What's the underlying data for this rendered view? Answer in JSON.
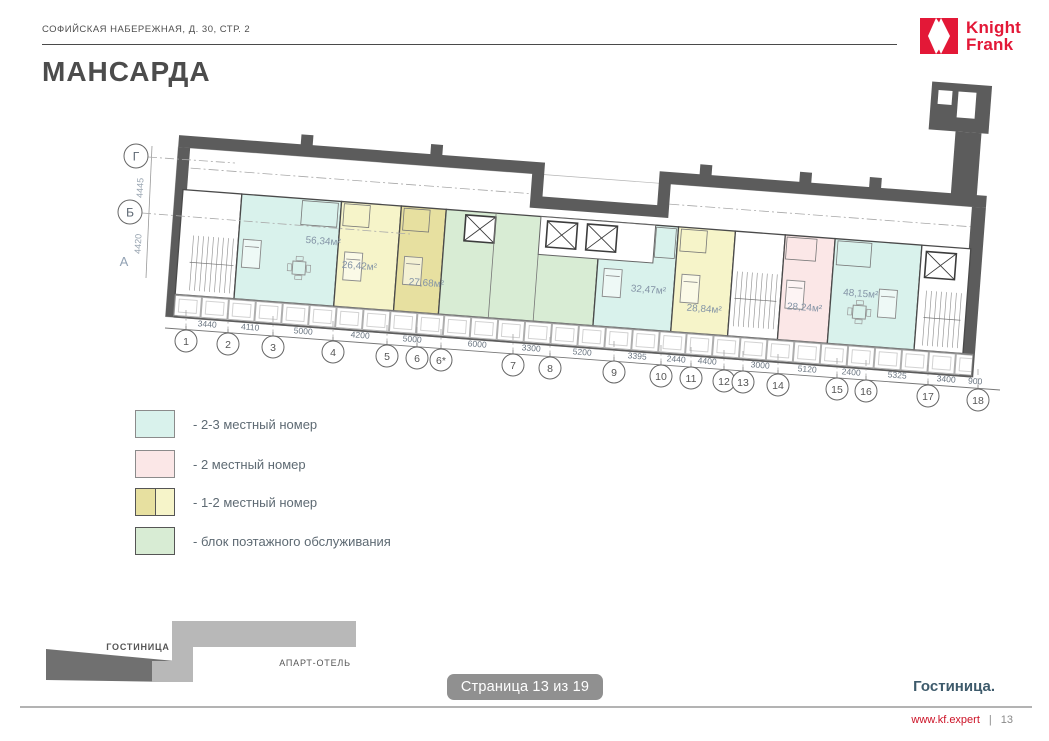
{
  "header": {
    "address": "СОФИЙСКАЯ НАБЕРЕЖНАЯ, Д. 30, СТР. 2",
    "logo_line1": "Knight",
    "logo_line2": "Frank"
  },
  "title": "МАНСАРДА",
  "palette": {
    "brand_red": "#e31837",
    "room_cyan": "#d9f2ec",
    "room_pink": "#fbe7e7",
    "room_yellow_dark": "#e7e0a0",
    "room_yellow_light": "#f6f4c9",
    "room_green": "#d8ecd4",
    "wall_dark": "#5c5c5c",
    "footer_section_color": "#3d5a6b"
  },
  "plan": {
    "axes": [
      {
        "label": "Г",
        "dim": "4445"
      },
      {
        "label": "Б",
        "dim": "4420"
      },
      {
        "label": "А"
      }
    ],
    "columns": [
      "1",
      "2",
      "3",
      "4",
      "5",
      "6",
      "6*",
      "7",
      "8",
      "9",
      "10",
      "11",
      "12",
      "13",
      "14",
      "15",
      "16",
      "17",
      "18"
    ],
    "dims": [
      "3440",
      "4110",
      "5000",
      "4200",
      "5000",
      "6000",
      "3300",
      "5200",
      "3395",
      "2440",
      "4400",
      "3000",
      "5120",
      "2400",
      "5325",
      "3400",
      "900"
    ],
    "rooms": [
      {
        "area": "56,34м²",
        "fill": "#d9f2ec"
      },
      {
        "area": "26,42м²",
        "fill": "#f6f4c9"
      },
      {
        "area": "27,68м²",
        "fill": "#e7e0a0"
      },
      {
        "area": "32,47м²",
        "fill": "#d9f2ec"
      },
      {
        "area": "28,84м²",
        "fill": "#f6f4c9"
      },
      {
        "area": "28,24м²",
        "fill": "#fbe7e7"
      },
      {
        "area": "48,15м²",
        "fill": "#d9f2ec"
      }
    ]
  },
  "legend": {
    "items": [
      {
        "label": "- 2-3 местный номер",
        "color": "#d9f2ec"
      },
      {
        "label": "- 2 местный номер",
        "color": "#fbe7e7"
      },
      {
        "label": "- 1-2 местный номер",
        "color": "#e7e0a0 / #f6f4c9"
      },
      {
        "label": "- блок поэтажного обслуживания",
        "color": "#d8ecd4"
      }
    ]
  },
  "minimap": {
    "hotel_label": "ГОСТИНИЦА",
    "apart_label": "АПАРТ-ОТЕЛЬ"
  },
  "page_overlay": "Страница 13 из 19",
  "footer": {
    "section": "Гостиница.",
    "site": "www.kf.expert",
    "separator": "|",
    "page": "13"
  }
}
